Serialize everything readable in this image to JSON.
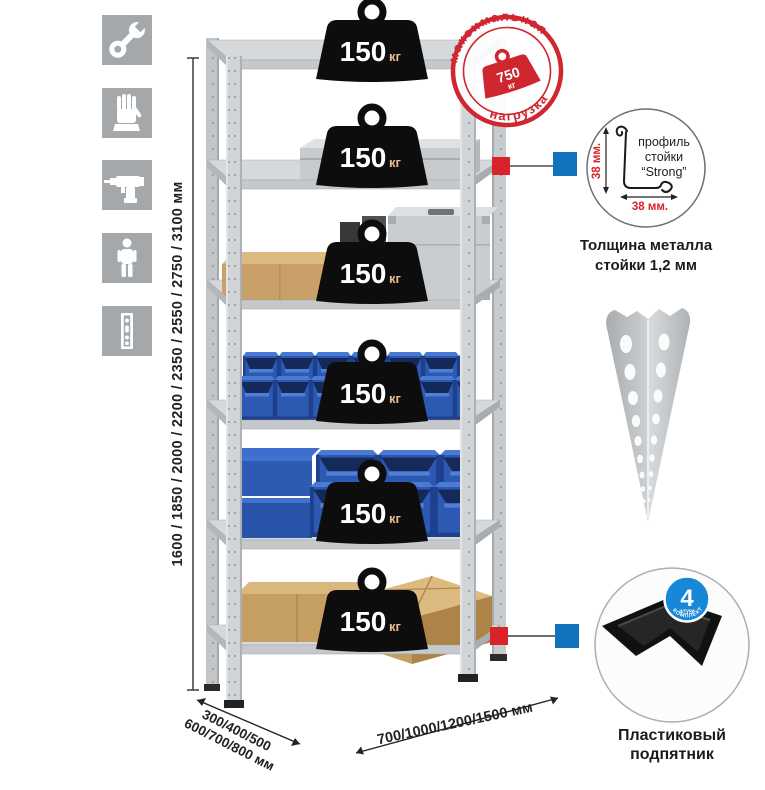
{
  "colors": {
    "accent_red": "#d8232a",
    "stamp_red": "#cf2630",
    "marker_blue": "#1173bd",
    "badge_blue": "#1787d8",
    "bin_blue": "#2d59b2",
    "metal_gray": "#d2d5d7",
    "icon_square_gray": "#a4a8ab",
    "cardboard": "#c59e62"
  },
  "left_toolbar": {
    "items": [
      {
        "icon": "wrench-icon"
      },
      {
        "icon": "gloves-icon"
      },
      {
        "icon": "drill-icon"
      },
      {
        "icon": "person-icon"
      },
      {
        "icon": "rack-post-icon"
      }
    ]
  },
  "height_dimension": {
    "label": "1600 / 1850 / 2000 / 2200 / 2350 / 2550 / 2750 / 3100 мм"
  },
  "rack": {
    "shelves": [
      {
        "load_value": "150",
        "load_unit": "кг",
        "items": []
      },
      {
        "load_value": "150",
        "load_unit": "кг",
        "items": [
          "aluminum-case"
        ]
      },
      {
        "load_value": "150",
        "load_unit": "кг",
        "items": [
          "cardboard-box",
          "dark-cases",
          "metal-case"
        ]
      },
      {
        "load_value": "150",
        "load_unit": "кг",
        "items": [
          "small-blue-bins"
        ]
      },
      {
        "load_value": "150",
        "load_unit": "кг",
        "items": [
          "large-blue-bins",
          "blue-containers"
        ]
      },
      {
        "load_value": "150",
        "load_unit": "кг",
        "items": [
          "cardboard-boxes"
        ]
      }
    ]
  },
  "max_load_stamp": {
    "arc_top": "максимальная",
    "arc_bottom": "нагрузка",
    "value": "750",
    "unit": "кг"
  },
  "profile_callout": {
    "text_line1": "профиль",
    "text_line2": "стойки",
    "text_line3": "“Strong”",
    "dim_height": "38 мм.",
    "dim_width": "38 мм.",
    "caption_line1": "Толщина металла",
    "caption_line2": "стойки 1,2 мм"
  },
  "foot_callout": {
    "badge_count": "4",
    "badge_sub": "штуки",
    "badge_arc": "В КОМПЛЕКТЕ",
    "caption_line1": "Пластиковый",
    "caption_line2": "подпятник"
  },
  "depth_dimension": {
    "line1": "300/400/500",
    "line2": "600/700/800 мм"
  },
  "width_dimension": {
    "label": "700/1000/1200/1500 мм"
  }
}
